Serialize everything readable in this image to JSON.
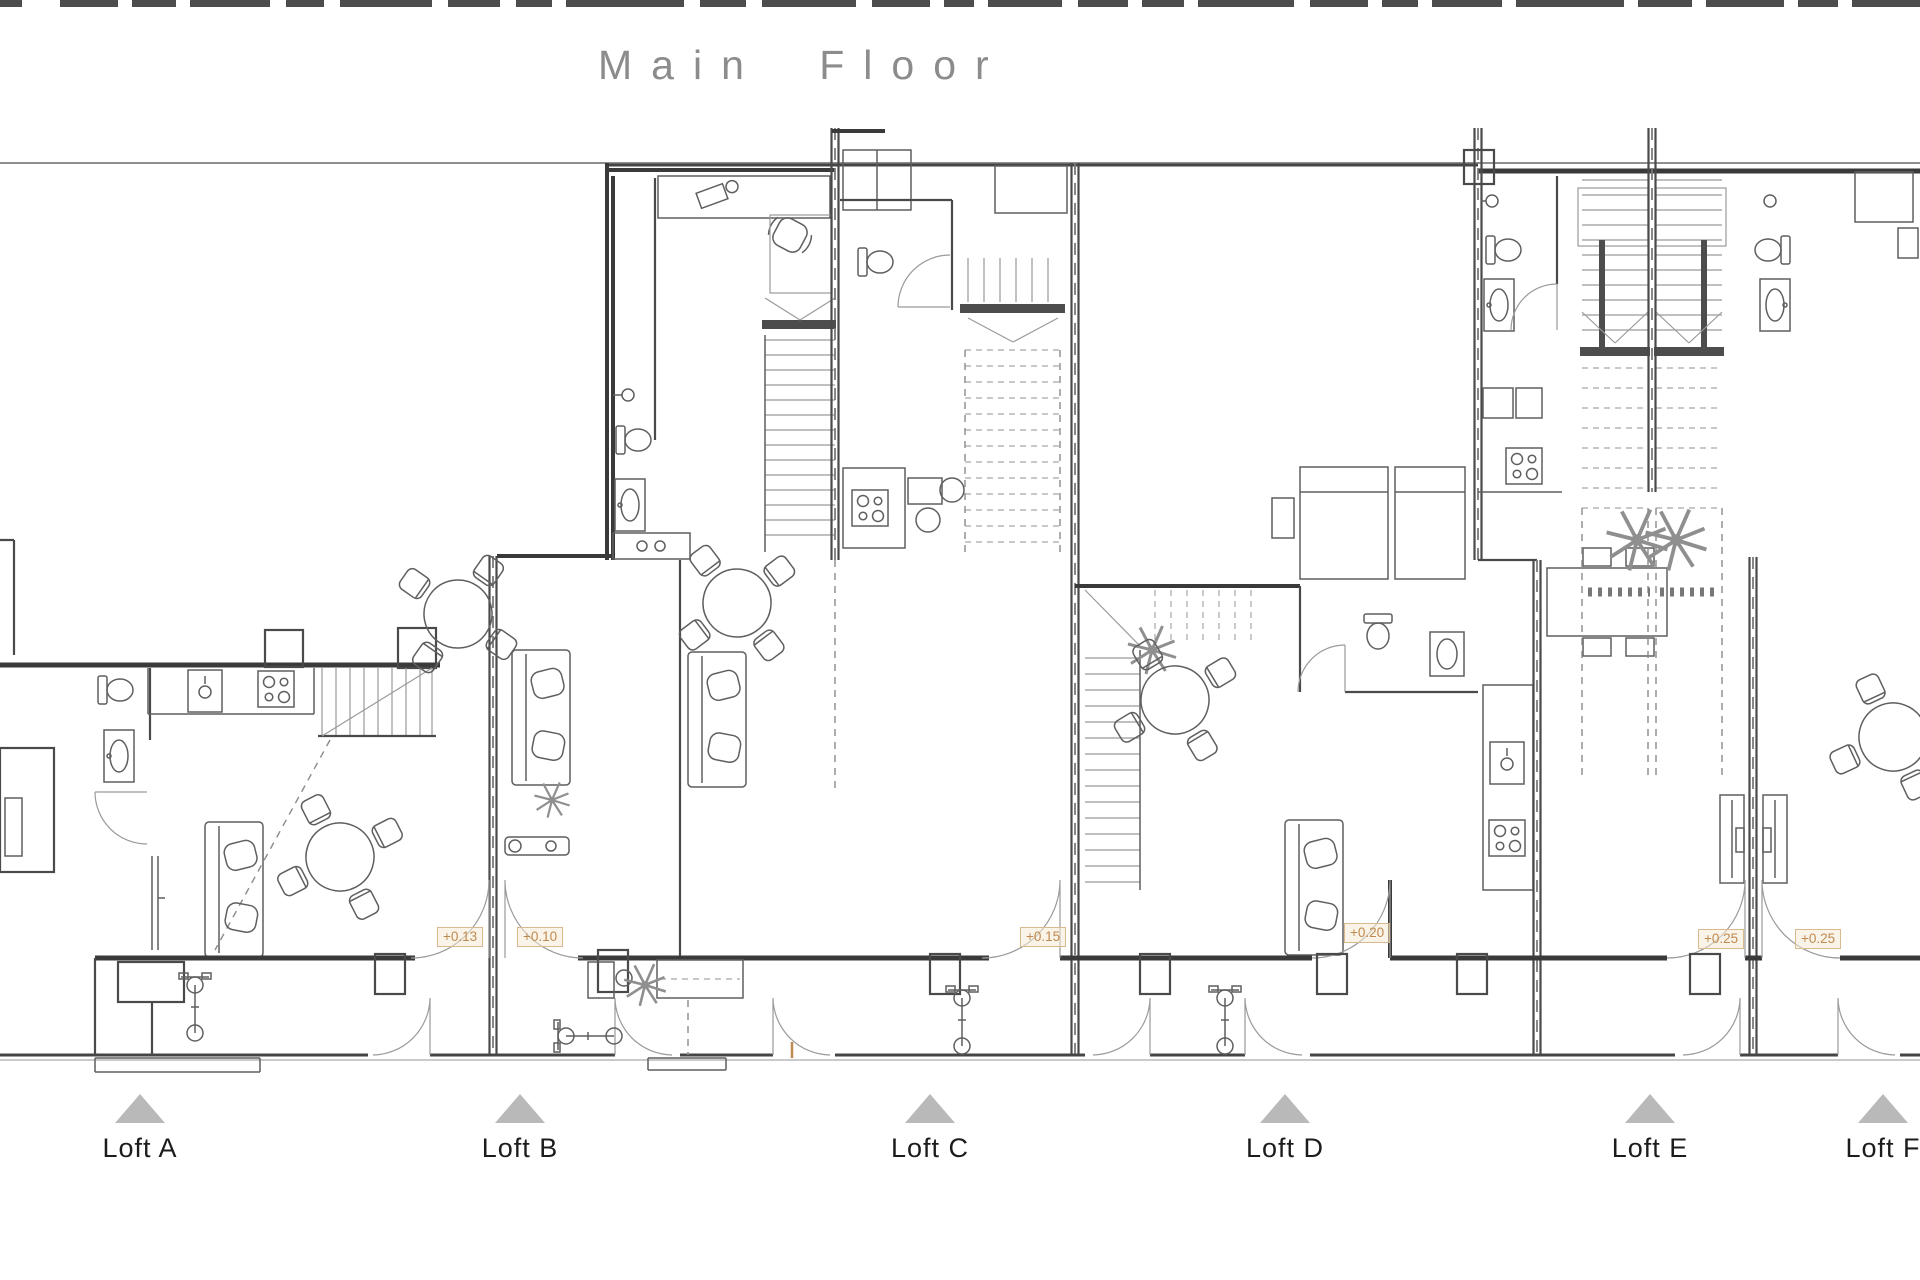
{
  "title": "Main Floor",
  "plan": {
    "type": "architectural floor plan",
    "units": [
      {
        "label": "Loft A"
      },
      {
        "label": "Loft B"
      },
      {
        "label": "Loft C"
      },
      {
        "label": "Loft D"
      },
      {
        "label": "Loft E"
      },
      {
        "label": "Loft F"
      }
    ],
    "elevation_markers": [
      {
        "value": "+0.13"
      },
      {
        "value": "+0.10"
      },
      {
        "value": "+0.15"
      },
      {
        "value": "+0.20"
      },
      {
        "value": "+0.25"
      },
      {
        "value": "+0.25"
      }
    ],
    "colors": {
      "marker_orange": "#bf8a50",
      "triangle_gray": "#b9b9b9",
      "title_gray": "#8c8c8c",
      "line_dark": "#3a3a3a"
    }
  }
}
